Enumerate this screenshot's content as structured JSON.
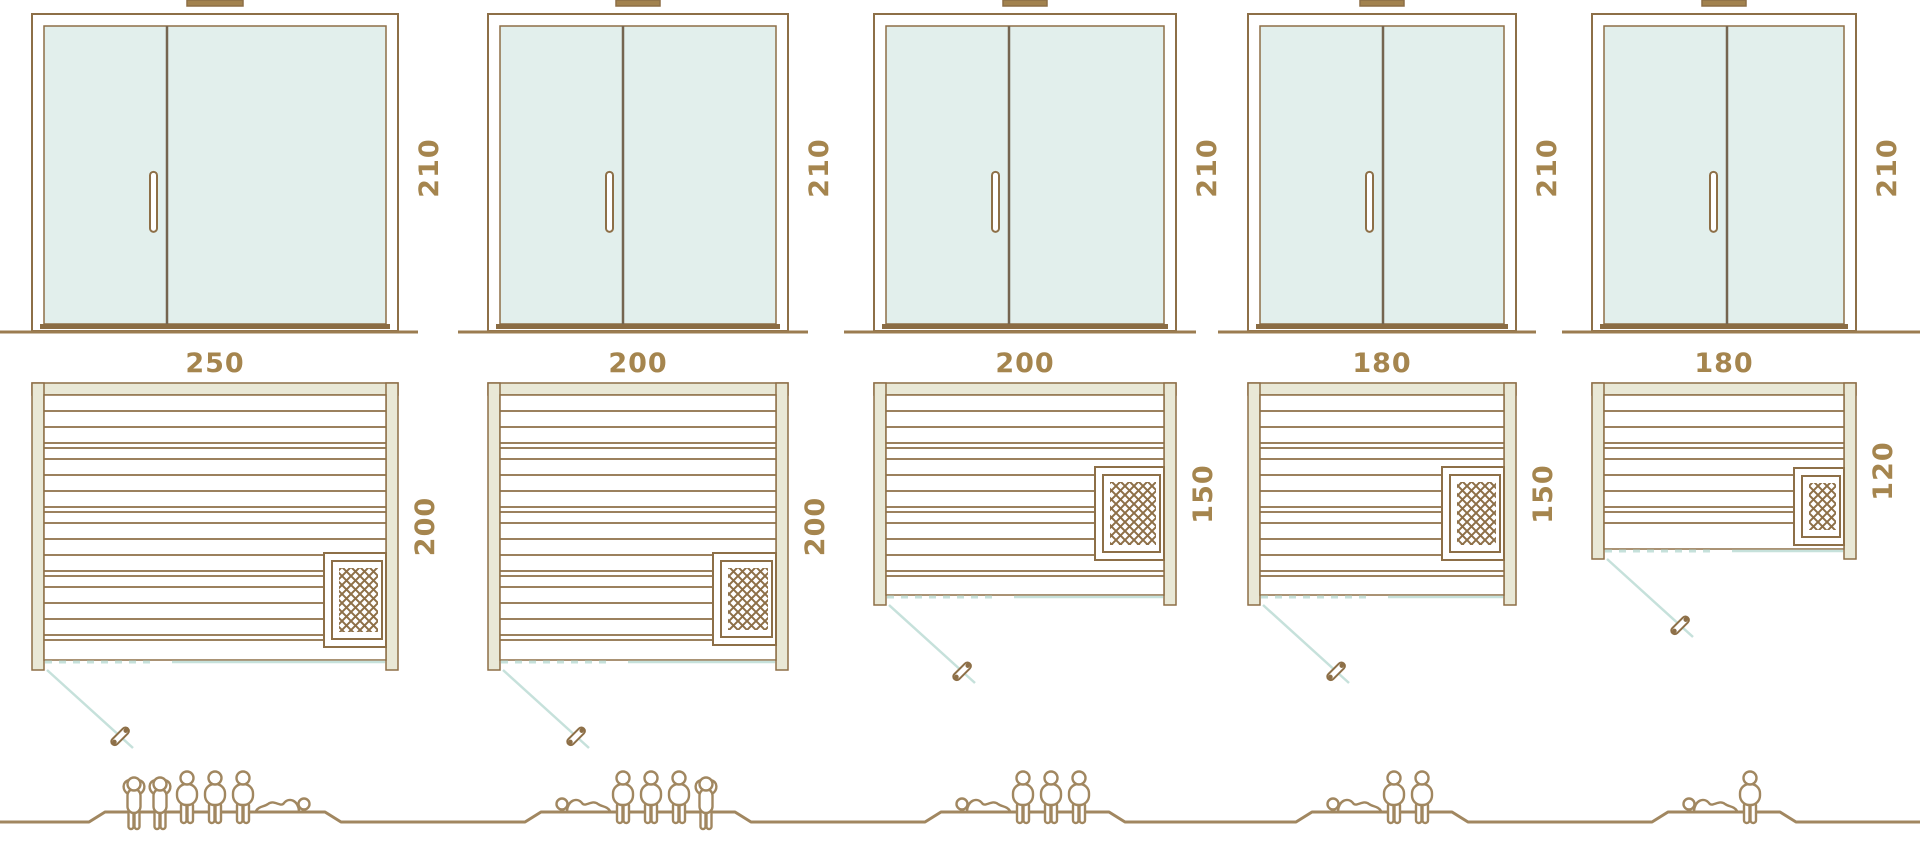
{
  "diagram_title": "sauna-sizes-comparison",
  "colors": {
    "line_brown": "#8d6f47",
    "cap_fill": "#a2824e",
    "wall_fill": "#e9e8d6",
    "frame_fill": "#ffffff",
    "glass_fill": "#e2efec",
    "glass_divider": "#756550",
    "threshold": "#8a6c44",
    "teal_door_line": "#c6e1db",
    "dimension_text": "#a5854e",
    "people_line": "#a18760",
    "ground_line": "#9b7c50",
    "background": "#ffffff"
  },
  "saunas": [
    {
      "name": "sauna-250x200",
      "width_cm": 250,
      "depth_cm": 200,
      "door_height_cm": 210,
      "labels": {
        "width": "250",
        "depth": "200",
        "height": "210"
      },
      "capacity": {
        "total": 6,
        "figures": [
          "standing",
          "standing",
          "sitting",
          "sitting",
          "sitting",
          "lying-right"
        ]
      }
    },
    {
      "name": "sauna-200x200",
      "width_cm": 200,
      "depth_cm": 200,
      "door_height_cm": 210,
      "labels": {
        "width": "200",
        "depth": "200",
        "height": "210"
      },
      "capacity": {
        "total": 5,
        "figures": [
          "lying-left",
          "sitting",
          "sitting",
          "sitting",
          "standing"
        ]
      }
    },
    {
      "name": "sauna-200x150",
      "width_cm": 200,
      "depth_cm": 150,
      "door_height_cm": 210,
      "labels": {
        "width": "200",
        "depth": "150",
        "height": "210"
      },
      "capacity": {
        "total": 4,
        "figures": [
          "lying-left",
          "sitting",
          "sitting",
          "sitting"
        ]
      }
    },
    {
      "name": "sauna-180x150",
      "width_cm": 180,
      "depth_cm": 150,
      "door_height_cm": 210,
      "labels": {
        "width": "180",
        "depth": "150",
        "height": "210"
      },
      "capacity": {
        "total": 3,
        "figures": [
          "lying-left",
          "sitting",
          "sitting"
        ]
      }
    },
    {
      "name": "sauna-180x120",
      "width_cm": 180,
      "depth_cm": 120,
      "door_height_cm": 210,
      "labels": {
        "width": "180",
        "depth": "120",
        "height": "210"
      },
      "capacity": {
        "total": 2,
        "figures": [
          "lying-left",
          "sitting"
        ]
      }
    }
  ]
}
